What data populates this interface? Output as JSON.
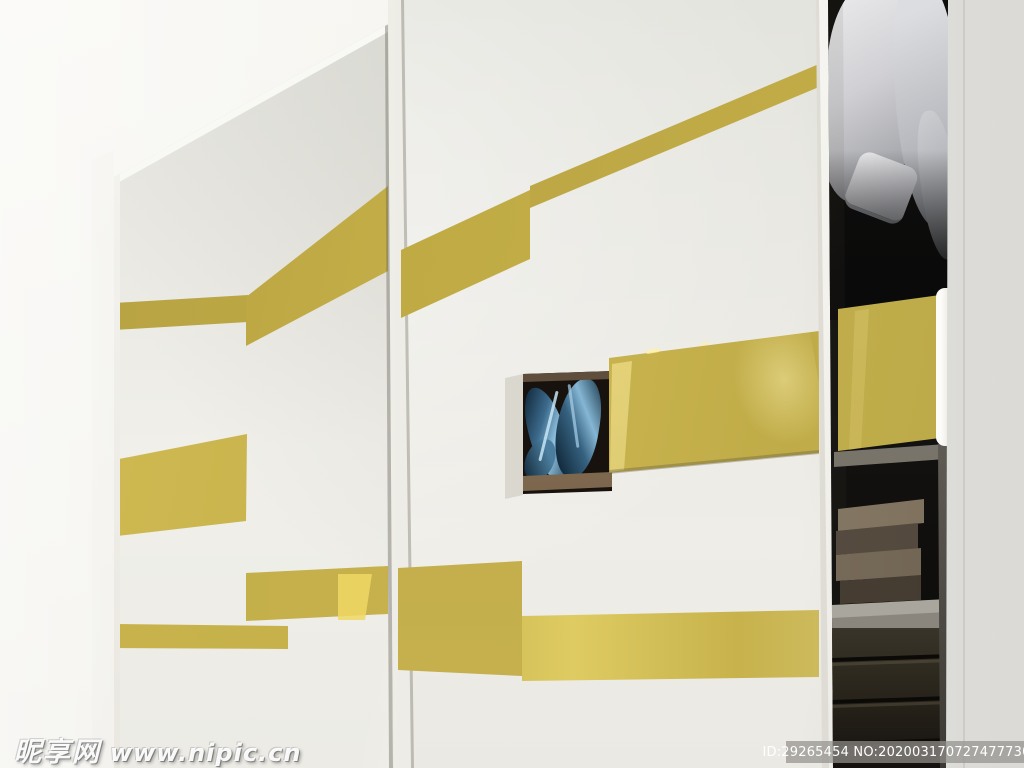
{
  "image": {
    "type": "photograph",
    "subject": "Modern wardrobe with white sliding doors decorated with glossy gold stripes; right section open showing hanging shirts, a gold sliding panel, stacked boxes, a shelf and drawers; a recessed display niche with blue glass sculptures in the middle door",
    "colors": {
      "wall": "#f4f3ee",
      "door_white": "#ecebe6",
      "accent_gold": "#c8b24a",
      "gold_bright": "#e8d464",
      "interior_dark": "#0d0b09",
      "shirt_white": "#d8d8da",
      "box_brown": "#8c7e6a",
      "shelf_grey": "#b3afa7",
      "glass_blue": "#5c8fb4",
      "side_panel_white": "#e6e5e1",
      "watermark_bar_grey": "#96948e"
    }
  },
  "watermark": {
    "site_name": "昵享网",
    "site_url": "www.nipic.cn"
  },
  "id_bar": {
    "text": "ID:29265454 NO:20200317072747773082"
  }
}
